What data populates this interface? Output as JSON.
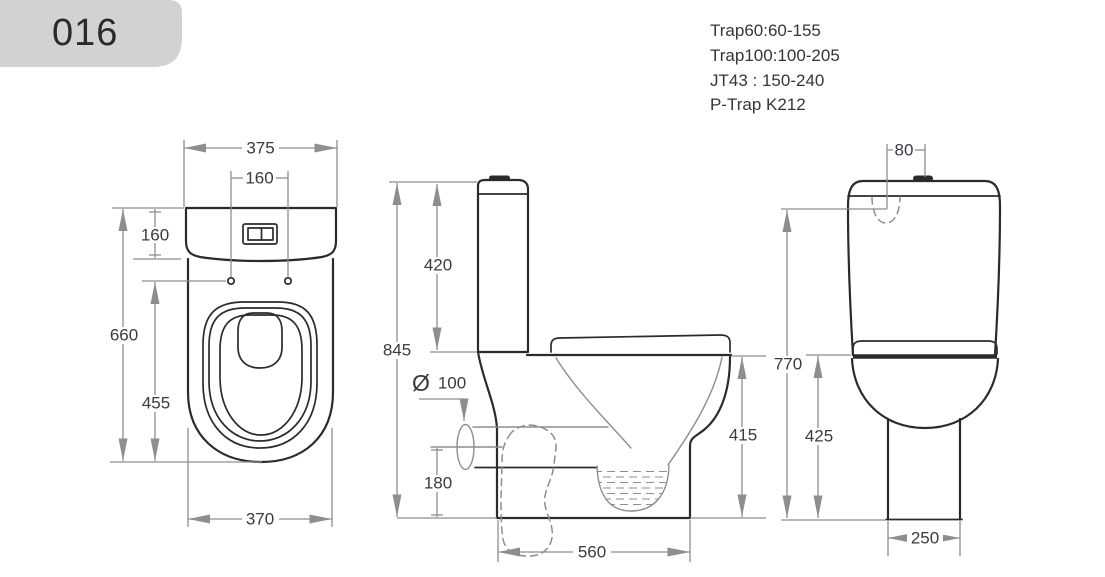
{
  "header": {
    "model": "016"
  },
  "notes": {
    "lines": [
      "Trap60:60-155",
      "Trap100:100-205",
      "JT43  : 150-240",
      "P-Trap K212"
    ]
  },
  "views": {
    "top": {
      "dims": {
        "width": "375",
        "hole_spacing": "160",
        "tank_depth": "160",
        "depth": "660",
        "hole_to_front": "455",
        "base_width": "370"
      }
    },
    "side": {
      "dims": {
        "height": "845",
        "tank_height": "420",
        "outlet_symbol": "Ø",
        "outlet_size": "100",
        "outlet_height": "180",
        "rim_height": "415",
        "depth": "560"
      }
    },
    "front": {
      "dims": {
        "inlet_offset": "80",
        "inlet_height": "770",
        "bowl_height": "425",
        "foot_width": "250"
      }
    }
  },
  "colors": {
    "outline": "#2b2b2d",
    "dimension": "#8e8e90",
    "label_text": "#3a3a42",
    "badge_bg": "#d2d2d4"
  }
}
